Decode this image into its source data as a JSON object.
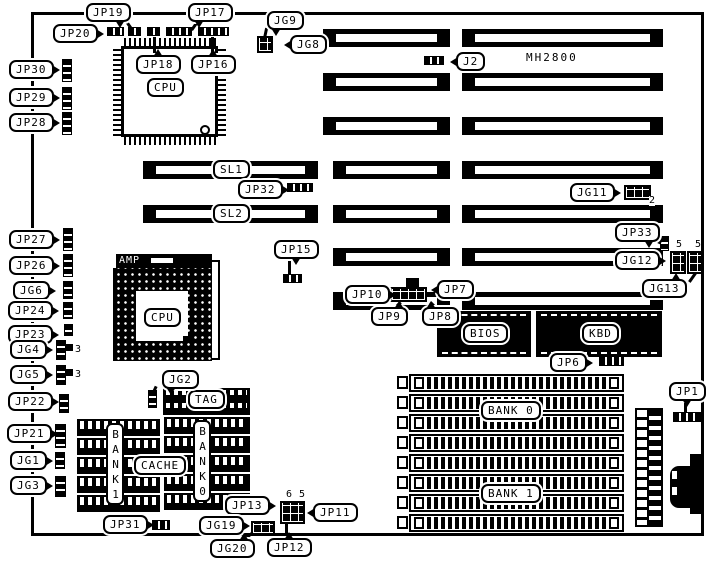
{
  "board": {
    "model": "MH2800",
    "chips": {
      "cpu_qfp": "CPU",
      "socket_brand": "AMP",
      "cpu_socket": "CPU",
      "tag": "TAG",
      "cache": "CACHE",
      "cache_bank1": "BANK1",
      "cache_bank0": "BANK0",
      "bios": "BIOS",
      "keyboard_controller": "KBD"
    },
    "slots": {
      "sl1": "SL1",
      "sl2": "SL2"
    },
    "memory": {
      "bank0": "BANK 0",
      "bank1": "BANK 1"
    },
    "callouts": {
      "jp19": "JP19",
      "jp17": "JP17",
      "jg9": "JG9",
      "jg8": "JG8",
      "jp20": "JP20",
      "jp18": "JP18",
      "jp16": "JP16",
      "j2": "J2",
      "jp30": "JP30",
      "jp29": "JP29",
      "jp28": "JP28",
      "jp32": "JP32",
      "jg11": "JG11",
      "jp33": "JP33",
      "jg12": "JG12",
      "jg13": "JG13",
      "jp15": "JP15",
      "jp27": "JP27",
      "jp26": "JP26",
      "jg6": "JG6",
      "jp24": "JP24",
      "jp23": "JP23",
      "jg4": "JG4",
      "jg5": "JG5",
      "jp22": "JP22",
      "jp21": "JP21",
      "jg1": "JG1",
      "jg3": "JG3",
      "jg2": "JG2",
      "jp10": "JP10",
      "jp7": "JP7",
      "jp9": "JP9",
      "jp8": "JP8",
      "jp6": "JP6",
      "jp1": "JP1",
      "jp31": "JP31",
      "jp13": "JP13",
      "jp11": "JP11",
      "jg19": "JG19",
      "jg20": "JG20",
      "jp12": "JP12"
    },
    "pin_markers": {
      "jg11_pin": "2",
      "jg4_pin": "3",
      "jg5_pin": "3",
      "jg12_pin": "5",
      "jg13_pin": "5",
      "jp11_pin6": "6",
      "jp11_pin5": "5"
    }
  }
}
